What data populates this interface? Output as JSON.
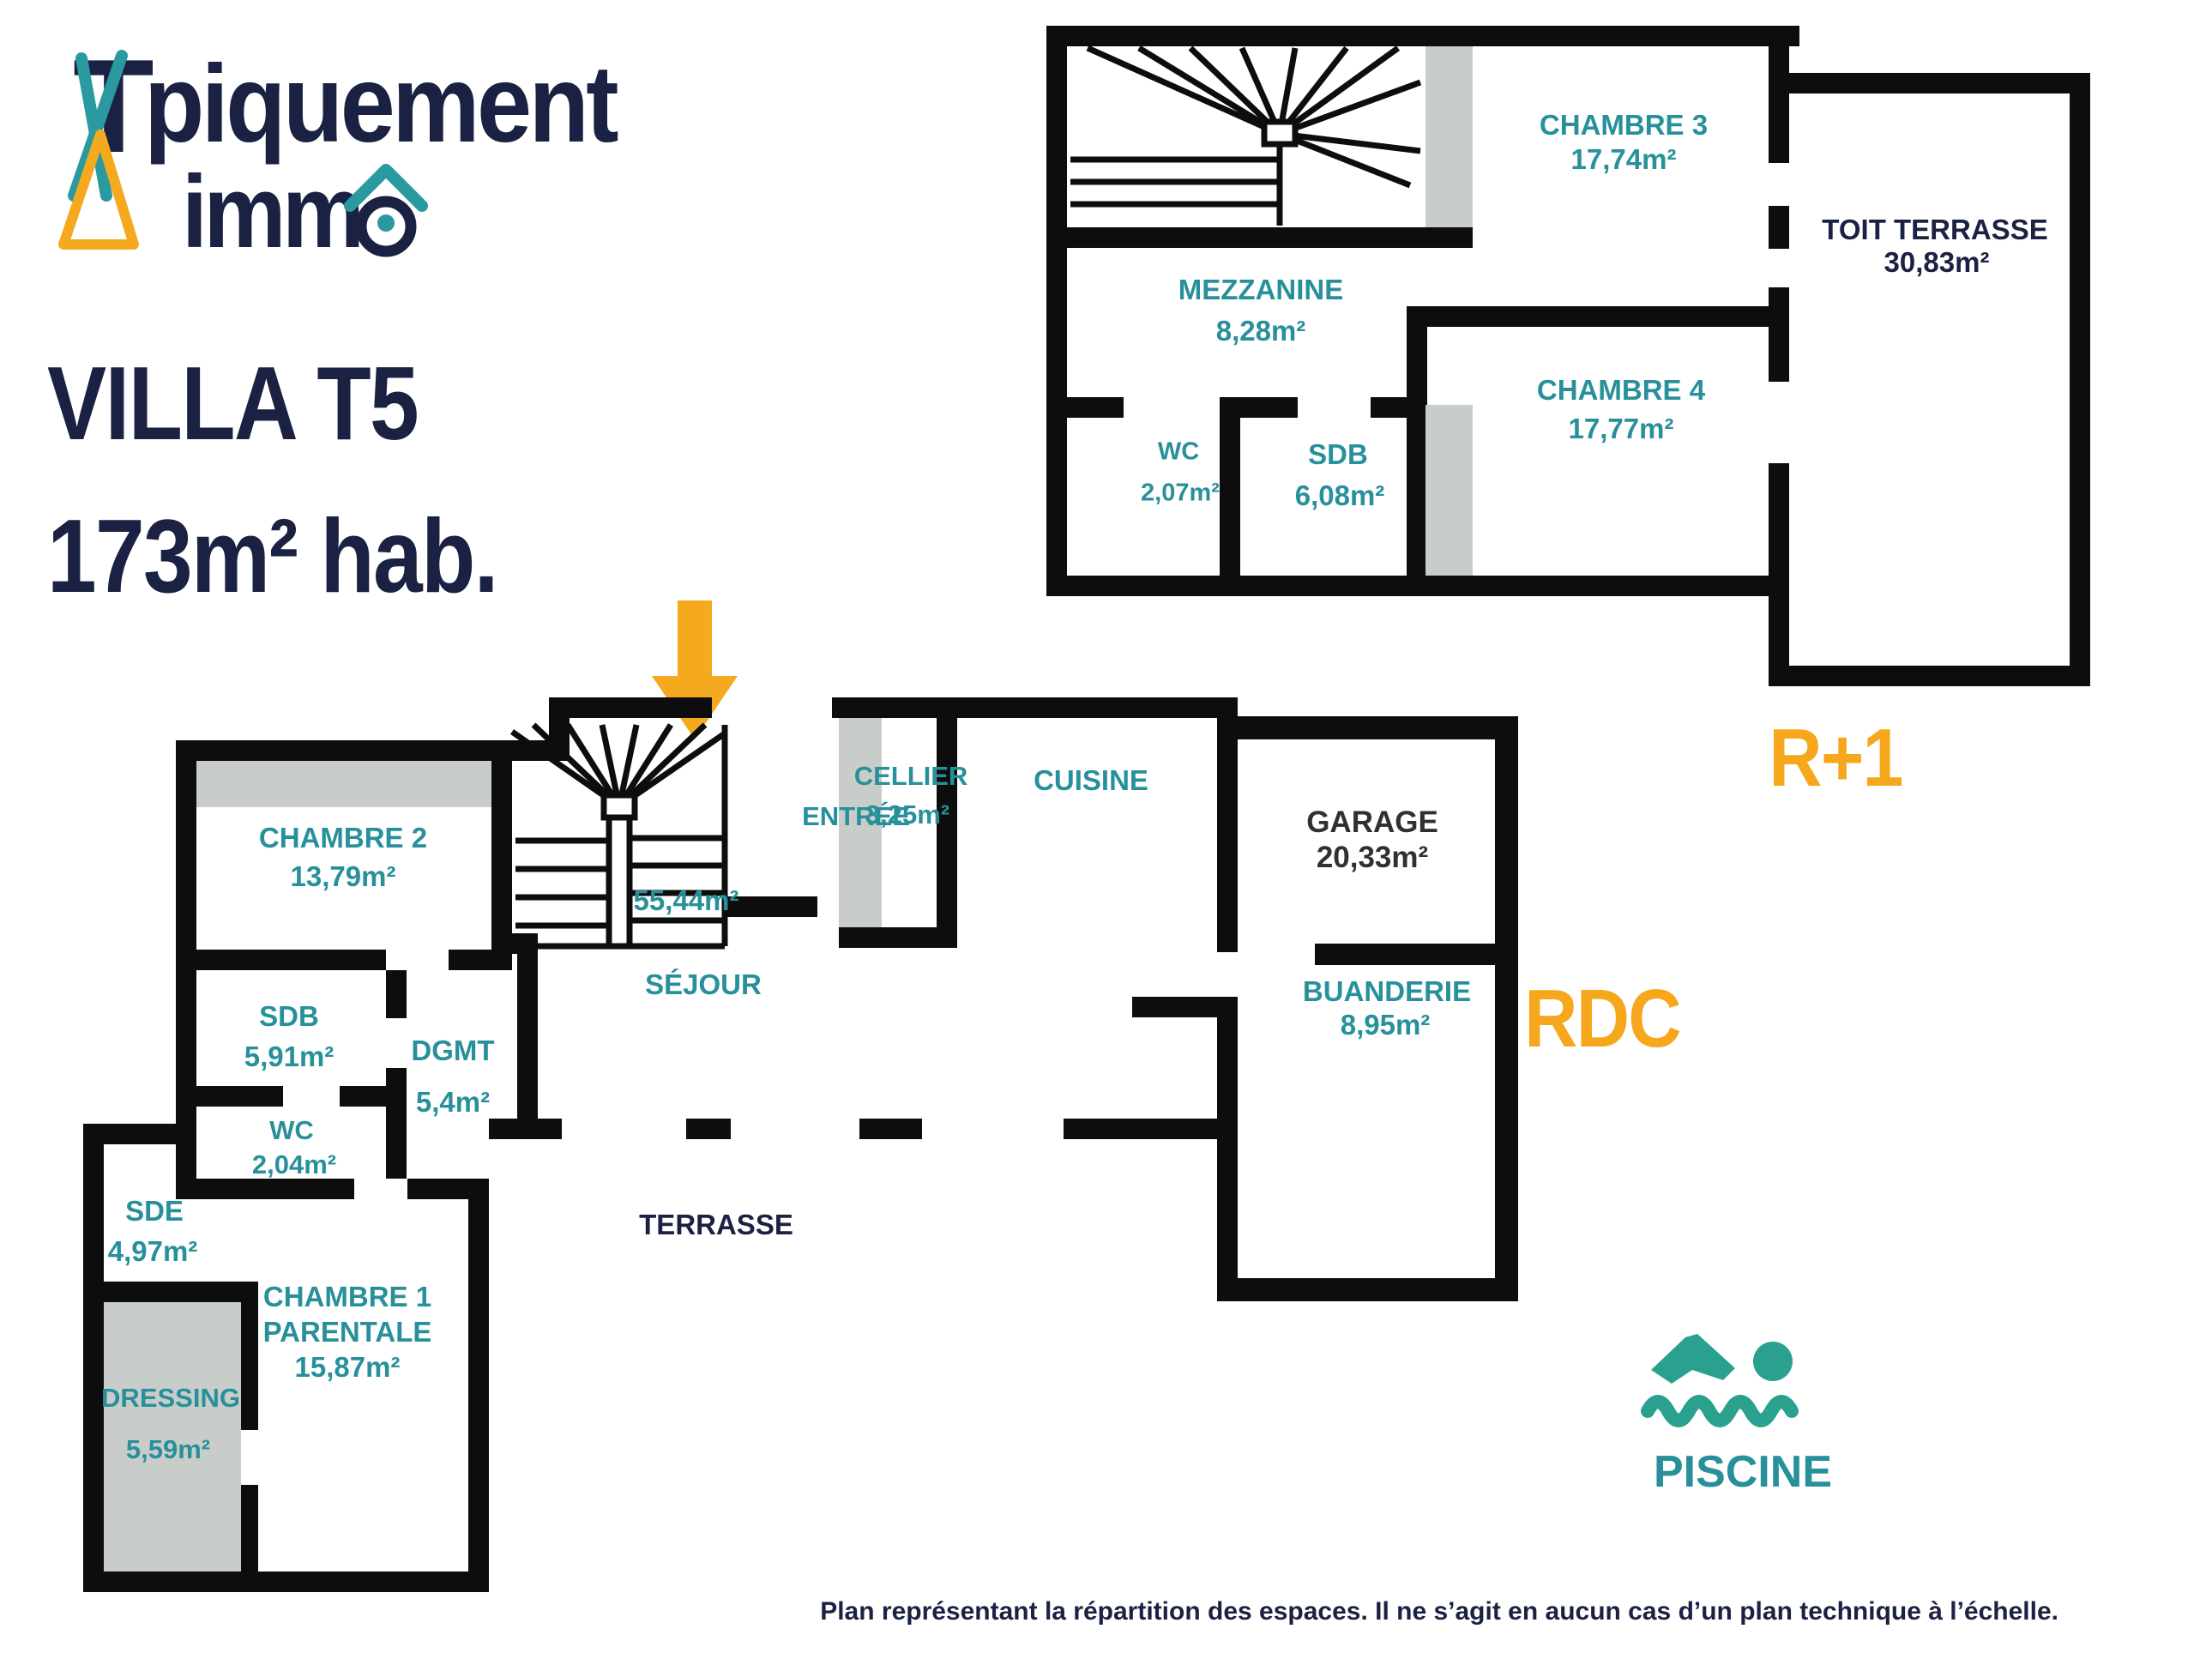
{
  "logo": {
    "brand_line1_t": "T",
    "brand_line1_rest": "piquement",
    "brand_line2": "imm"
  },
  "title": {
    "line1": "VILLA T5",
    "line2": "173m² hab."
  },
  "r1_plan": {
    "floor_label": "R+1",
    "chambre3": {
      "name": "CHAMBRE 3",
      "area": "17,74m²"
    },
    "mezzanine": {
      "name": "MEZZANINE",
      "area": "8,28m²"
    },
    "wc": {
      "name": "WC",
      "area": "2,07m²"
    },
    "sdb": {
      "name": "SDB",
      "area": "6,08m²"
    },
    "chambre4": {
      "name": "CHAMBRE 4",
      "area": "17,77m²"
    },
    "toit_terrasse": {
      "name": "TOIT TERRASSE",
      "area": "30,83m²"
    }
  },
  "rdc_plan": {
    "floor_label": "RDC",
    "entree": {
      "name": "ENTRÉE"
    },
    "cellier": {
      "name": "CELLIER",
      "area": "3,25m²"
    },
    "cuisine": {
      "name": "CUISINE"
    },
    "sejour": {
      "name": "SÉJOUR",
      "area": "55,44m²"
    },
    "chambre2": {
      "name": "CHAMBRE 2",
      "area": "13,79m²"
    },
    "sdb": {
      "name": "SDB",
      "area": "5,91m²"
    },
    "dgmt": {
      "name": "DGMT",
      "area": "5,4m²"
    },
    "wc": {
      "name": "WC",
      "area": "2,04m²"
    },
    "sde": {
      "name": "SDE",
      "area": "4,97m²"
    },
    "dressing": {
      "name": "DRESSING",
      "area": "5,59m²"
    },
    "chambre1": {
      "name": "CHAMBRE 1",
      "name2": "PARENTALE",
      "area": "15,87m²"
    },
    "garage": {
      "name": "GARAGE",
      "area": "20,33m²"
    },
    "buanderie": {
      "name": "BUANDERIE",
      "area": "8,95m²"
    },
    "terrasse": {
      "name": "TERRASSE"
    },
    "piscine": {
      "name": "PISCINE"
    }
  },
  "footer": {
    "disclaimer": "Plan représentant la répartition des espaces. Il ne s’agit en aucun cas d’un plan technique à l’échelle."
  },
  "colors": {
    "teal": "#28909a",
    "navy": "#1b2142",
    "orange": "#f6a71b",
    "dark": "#2e3033",
    "wall": "#0d0d0d",
    "gray_fill": "#c9cdca"
  }
}
